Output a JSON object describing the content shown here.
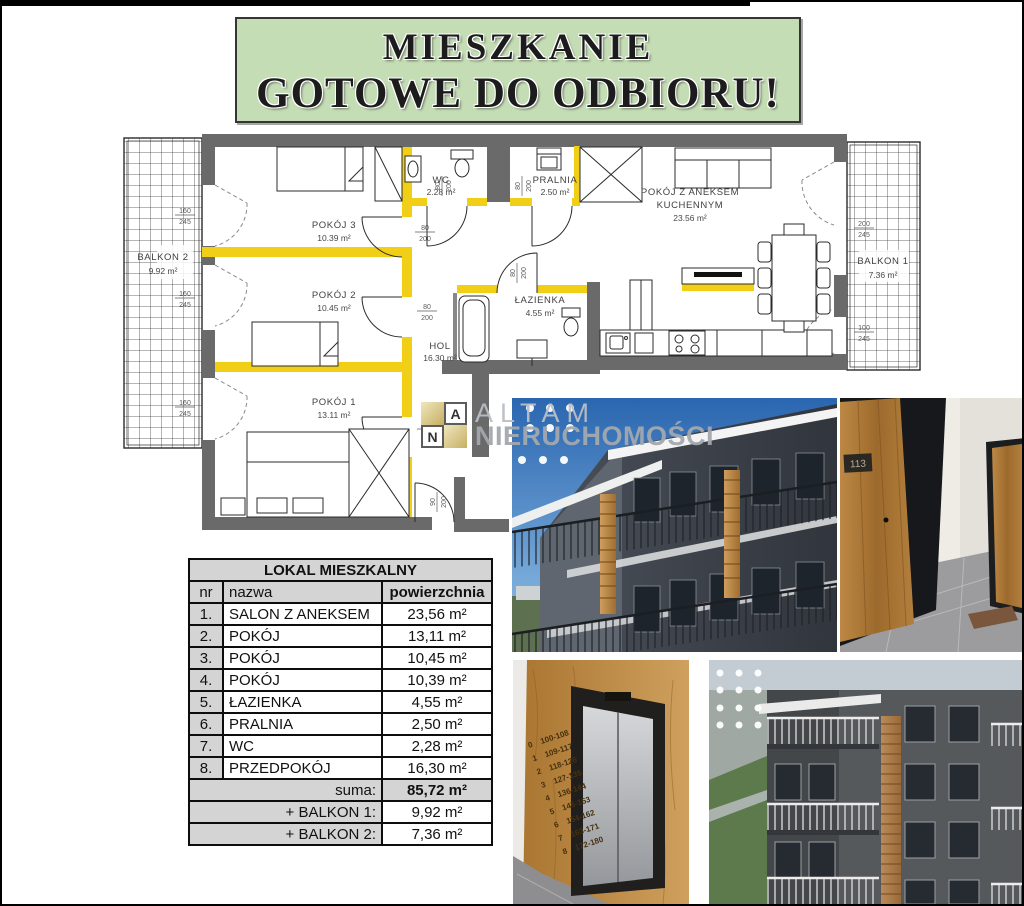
{
  "banner": {
    "line1": "MIESZKANIE",
    "line2": "GOTOWE DO ODBIORU!",
    "bg": "#c5ddb5"
  },
  "plan": {
    "wall_color": "#6a6a6a",
    "accent_color": "#f2cf17",
    "rooms": {
      "pokoj3": {
        "name": "POKÓJ 3",
        "area": "10.39 m²"
      },
      "pokoj2": {
        "name": "POKÓJ 2",
        "area": "10.45 m²"
      },
      "pokoj1": {
        "name": "POKÓJ 1",
        "area": "13.11 m²"
      },
      "wc": {
        "name": "WC",
        "area": "2.28 m²"
      },
      "pralnia": {
        "name": "PRALNIA",
        "area": "2.50 m²"
      },
      "salon": {
        "name1": "POKÓJ Z ANEKSEM",
        "name2": "KUCHENNYM",
        "area": "23.56 m²"
      },
      "lazienka": {
        "name": "ŁAZIENKA",
        "area": "4.55 m²"
      },
      "hol": {
        "name": "HOL",
        "area": "16.30 m²"
      },
      "balkon2": {
        "name": "BALKON 2",
        "area": "9.92 m²"
      },
      "balkon1": {
        "name": "BALKON 1",
        "area": "7.36 m²"
      }
    },
    "dims": {
      "balcony": {
        "top": "160",
        "bot": "245"
      },
      "door": {
        "top": "80",
        "bot": "200"
      },
      "entrance": {
        "top": "90",
        "bot": "200"
      },
      "right_top": {
        "top": "200",
        "bot": "245"
      },
      "right_bottom": {
        "top": "100",
        "bot": "245"
      }
    }
  },
  "logo": {
    "letter_a": "A",
    "letter_n": "N",
    "line1": "ALTAM",
    "line2": "NIERUCHOMOŚCI"
  },
  "table": {
    "title": "LOKAL MIESZKALNY",
    "headers": {
      "nr": "nr",
      "name": "nazwa",
      "area": "powierzchnia"
    },
    "rows": [
      {
        "nr": "1.",
        "name": "SALON Z ANEKSEM",
        "area": "23,56 m²"
      },
      {
        "nr": "2.",
        "name": "POKÓJ",
        "area": "13,11 m²"
      },
      {
        "nr": "3.",
        "name": "POKÓJ",
        "area": "10,45 m²"
      },
      {
        "nr": "4.",
        "name": "POKÓJ",
        "area": "10,39 m²"
      },
      {
        "nr": "5.",
        "name": "ŁAZIENKA",
        "area": "4,55 m²"
      },
      {
        "nr": "6.",
        "name": "PRALNIA",
        "area": "2,50 m²"
      },
      {
        "nr": "7.",
        "name": "WC",
        "area": "2,28 m²"
      },
      {
        "nr": "8.",
        "name": "PRZEDPOKÓJ",
        "area": "16,30 m²"
      }
    ],
    "summary": [
      {
        "label": "suma:",
        "value": "85,72 m²"
      },
      {
        "label": "+ BALKON 1:",
        "value": "9,92 m²"
      },
      {
        "label": "+ BALKON 2:",
        "value": "7,36 m²"
      }
    ]
  },
  "photos": {
    "door_number": "113",
    "elevator_floors": [
      {
        "floor": "0",
        "range": "100-108"
      },
      {
        "floor": "1",
        "range": "109-117"
      },
      {
        "floor": "2",
        "range": "118-126"
      },
      {
        "floor": "3",
        "range": "127-135"
      },
      {
        "floor": "4",
        "range": "136-144"
      },
      {
        "floor": "5",
        "range": "145-153"
      },
      {
        "floor": "6",
        "range": "154-162"
      },
      {
        "floor": "7",
        "range": "163-171"
      },
      {
        "floor": "8",
        "range": "172-180"
      }
    ]
  }
}
